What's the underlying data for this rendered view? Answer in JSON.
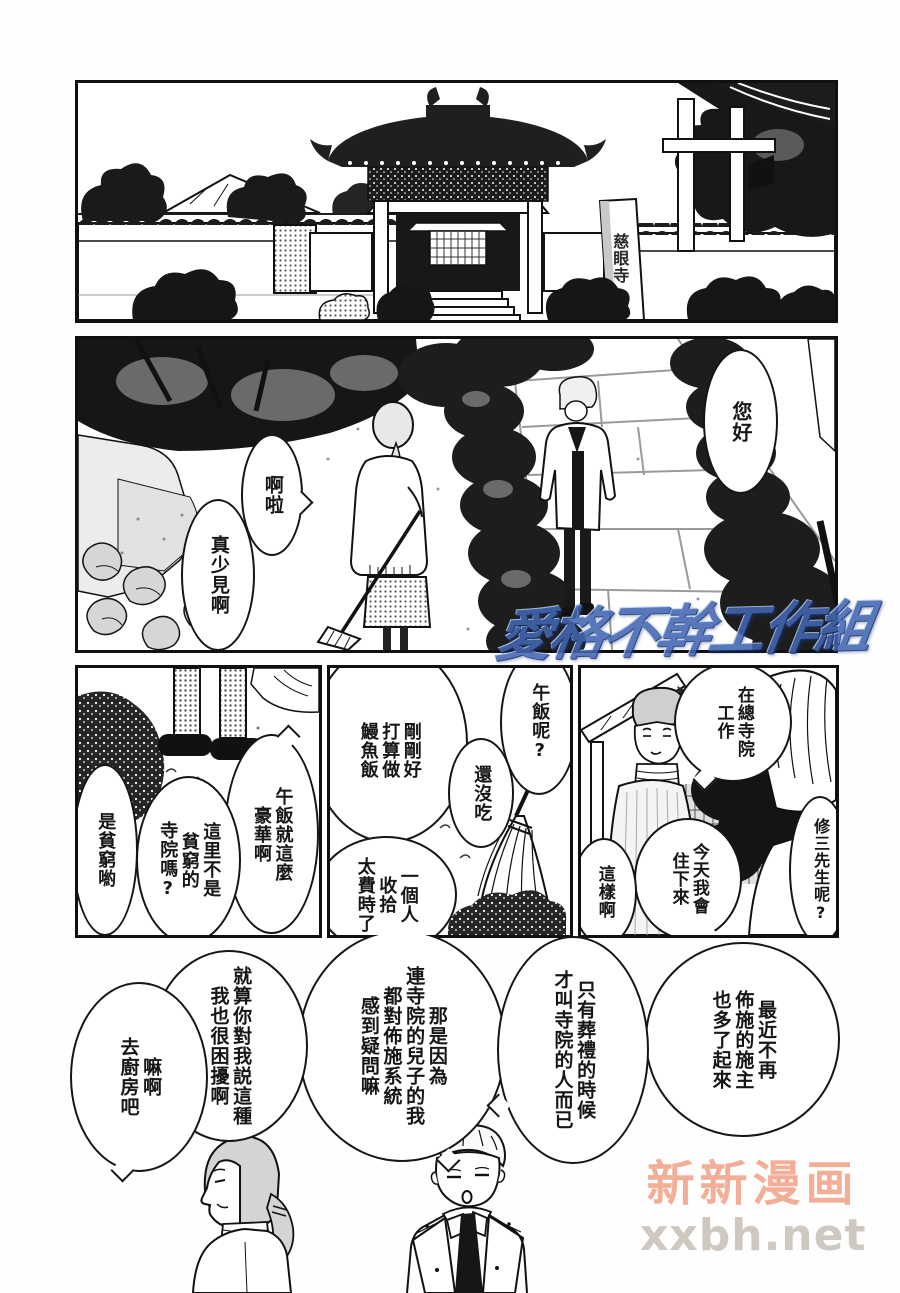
{
  "page": {
    "panels": {
      "temple_gate": {
        "sign": "慈眼寺"
      },
      "garden": {
        "bubble_hello": [
          "您好"
        ],
        "bubble_ara": [
          "啊啦"
        ],
        "bubble_rare": [
          "真少見啊"
        ]
      },
      "lunch_left": {
        "bubble_luxury": [
          "午飯就這麼",
          "豪華啊"
        ],
        "bubble_poor_temple": [
          "這里不是",
          "貧窮的",
          "寺院嗎?"
        ],
        "bubble_is_poor": [
          "是貧窮喲"
        ]
      },
      "lunch_middle": {
        "bubble_unagi": [
          "剛剛好",
          "打算做",
          "鰻魚飯"
        ],
        "bubble_lunch_q": [
          "午飯呢?"
        ],
        "bubble_not_yet": [
          "還沒吃"
        ],
        "bubble_takes_time": [
          "一個人",
          "收拾",
          "太費時了"
        ]
      },
      "lunch_right": {
        "bubble_head_temple": [
          "在總寺院",
          "工作"
        ],
        "bubble_shuzo_q": [
          "修三先生呢?"
        ],
        "bubble_stay": [
          "今天我會",
          "住下來"
        ],
        "bubble_i_see": [
          "這樣啊"
        ]
      },
      "bottom": {
        "bubble_donors": [
          "最近不再",
          "佈施的施主",
          "也多了起來"
        ],
        "bubble_funeral": [
          "只有葬禮的時候",
          "才叫寺院的人而已"
        ],
        "bubble_doubt": [
          "那是因為",
          "連寺院的兒子的我",
          "都對佈施系統",
          "感到疑問嘛"
        ],
        "bubble_troubled": [
          "就算你對我説這種",
          "我也很困擾啊"
        ],
        "bubble_kitchen": [
          "嘛啊",
          "去廚房吧"
        ]
      }
    },
    "watermarks": {
      "scanlation_group": "愛格不幹工作組",
      "site_name": "新新漫画",
      "site_url": "xxbh.net"
    },
    "colors": {
      "site_name_color": "#f0a184",
      "site_url_color": "#cbc3ba",
      "logo_blue": "#4266b2",
      "ink": "#151515"
    }
  }
}
